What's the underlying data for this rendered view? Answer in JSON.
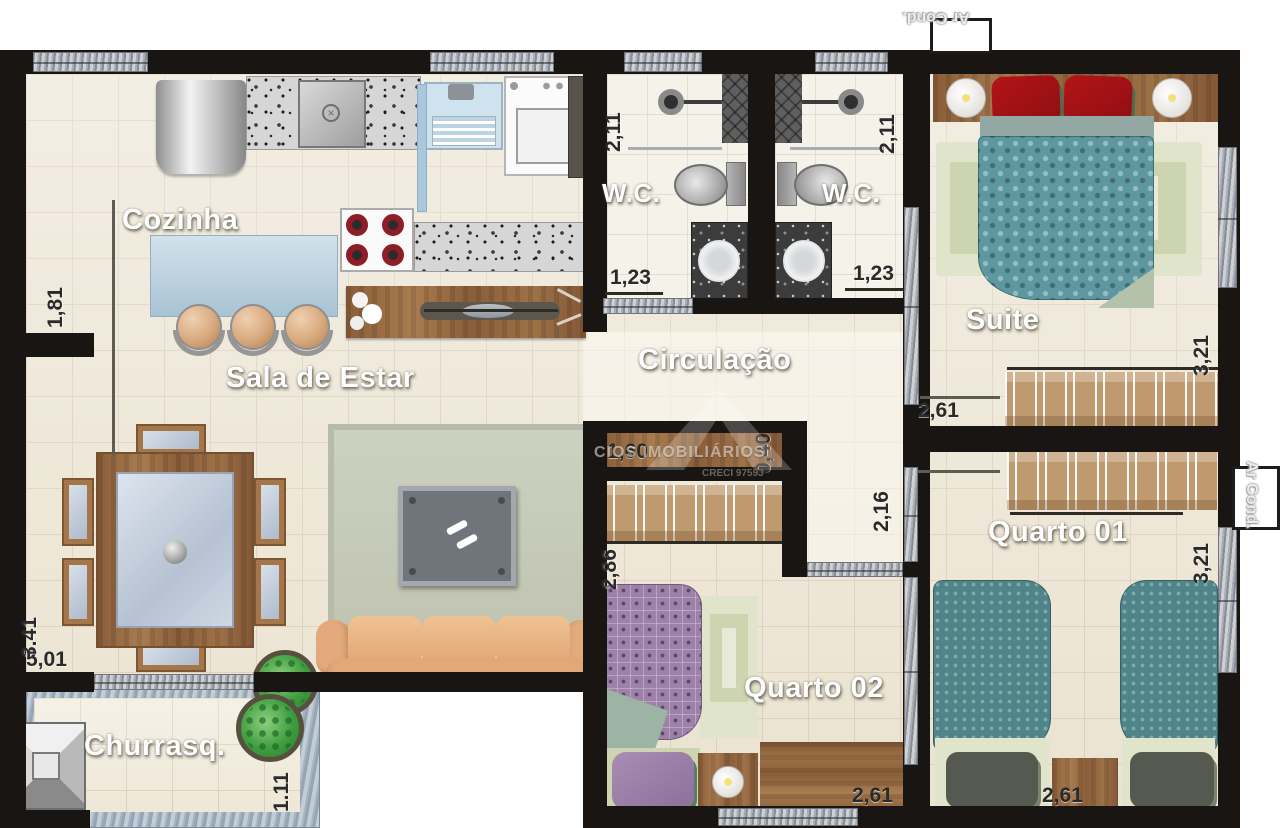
{
  "plan_type": "apartment-floor-plan",
  "rooms": {
    "cozinha": "Cozinha",
    "sala": "Sala de Estar",
    "circulacao": "Circulação",
    "wc_left": "W.C.",
    "wc_right": "W.C.",
    "suite": "Suite",
    "quarto01": "Quarto 01",
    "quarto02": "Quarto 02",
    "churrasqueira": "Churrasq."
  },
  "dimensions": {
    "cozinha_left": "1,81",
    "wc_left_depth": "2,11",
    "wc_left_width": "1,23",
    "wc_right_depth": "2,11",
    "wc_right_width": "1,23",
    "suite_width": "2,61",
    "suite_depth": "3,21",
    "hall_closet_width": "1,60",
    "hall_closet_depth": "0,40",
    "hall_depth": "2,16",
    "quarto02_depth": "2,86",
    "quarto02_width": "2,61",
    "quarto01_depth": "3,21",
    "quarto01_width": "2,61",
    "sala_depth": "3.41",
    "sala_width": "5,01",
    "churrasqueira_width": "1.11"
  },
  "annotations": {
    "ac_top": "Ar Cond.",
    "ac_right": "Ar Cond."
  },
  "watermark": {
    "brand": "CIOS IMOBILIÁRIOS",
    "creci": "CRECI 9759J"
  },
  "colors": {
    "wall": "#181512",
    "window": "#a9aeb4",
    "floor": "#ebe3d1",
    "wood": "#9a6f46",
    "teal_bed": "#5e97a0",
    "purple_bed": "#9d81a9",
    "red_pillow": "#a01116"
  }
}
